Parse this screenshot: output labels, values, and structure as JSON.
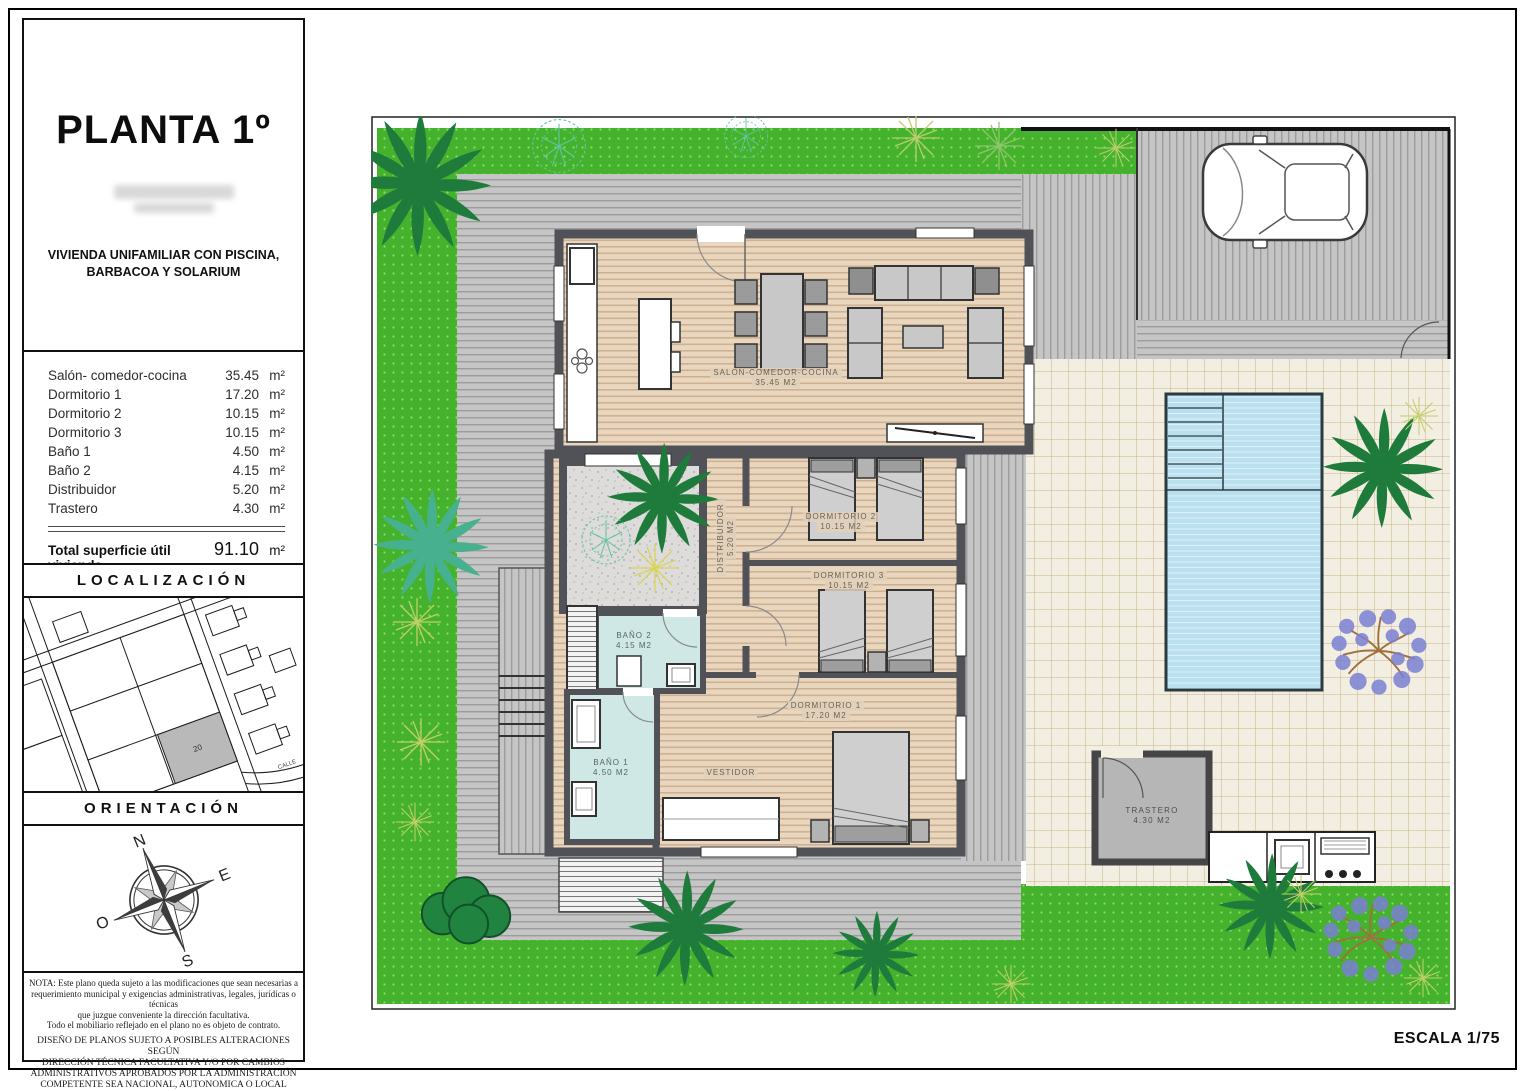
{
  "page": {
    "scale_label": "ESCALA 1/75"
  },
  "sidebar": {
    "title": "PLANTA 1º",
    "subtitle": [
      "VIVIENDA UNIFAMILIAR CON PISCINA,",
      "BARBACOA Y SOLARIUM"
    ],
    "areas": [
      {
        "label": "Salón- comedor-cocina",
        "value": "35.45",
        "unit": "m²"
      },
      {
        "label": "Dormitorio 1",
        "value": "17.20",
        "unit": "m²"
      },
      {
        "label": "Dormitorio 2",
        "value": "10.15",
        "unit": "m²"
      },
      {
        "label": "Dormitorio 3",
        "value": "10.15",
        "unit": "m²"
      },
      {
        "label": "Baño 1",
        "value": "4.50",
        "unit": "m²"
      },
      {
        "label": "Baño 2",
        "value": "4.15",
        "unit": "m²"
      },
      {
        "label": "Distribuidor",
        "value": "5.20",
        "unit": "m²"
      },
      {
        "label": "Trastero",
        "value": "4.30",
        "unit": "m²"
      }
    ],
    "total": {
      "label": "Total superficie útil vivienda",
      "value": "91.10",
      "unit": "m²"
    },
    "solarium": {
      "label": "Solarium",
      "value": "98.56",
      "unit": "m²"
    },
    "localizacion": {
      "header": "LOCALIZACIÓN",
      "parcel_number": "20",
      "street_label": "CALLE"
    },
    "orientacion": {
      "header": "ORIENTACIÓN",
      "compass": {
        "n": "N",
        "e": "E",
        "s": "S",
        "o": "O"
      }
    },
    "notes": {
      "nota_lines": [
        "NOTA: Este plano queda sujeto a las modificaciones que sean necesarias a",
        "requerimiento municipal y exigencias administrativas, legales, jurídicas o técnicas",
        "que juzgue conveniente la dirección facultativa.",
        "Todo el mobiliario reflejado en el plano no es objeto de contrato."
      ],
      "diseno_lines": [
        "DISEÑO DE PLANOS SUJETO A POSIBLES ALTERACIONES SEGÚN",
        "DIRECCIÓN TÉCNICA FACULTATIVA Y/O POR CAMBIOS",
        "ADMINISTRATIVOS APROBADOS POR LA ADMINISTRACIÓN",
        "COMPETENTE SEA NACIONAL, AUTONOMICA O LOCAL"
      ]
    }
  },
  "plan": {
    "labels": {
      "salon": {
        "name": "SALON-COMEDOR-COCINA",
        "area": "35.45 M2"
      },
      "dormitorio1": {
        "name": "DORMITORIO 1",
        "area": "17.20 M2"
      },
      "dormitorio2": {
        "name": "DORMITORIO 2",
        "area": "10.15 M2"
      },
      "dormitorio3": {
        "name": "DORMITORIO 3",
        "area": "10.15 M2"
      },
      "bano1": {
        "name": "BAÑO 1",
        "area": "4.50 M2"
      },
      "bano2": {
        "name": "BAÑO 2",
        "area": "4.15 M2"
      },
      "distribuidor": {
        "name": "DISTRIBUIDOR",
        "area": "5.20 M2"
      },
      "vestidor": {
        "name": "VESTIDOR"
      },
      "trastero": {
        "name": "TRASTERO",
        "area": "4.30 M2"
      }
    },
    "colors": {
      "grass": "#45b22d",
      "grass_dot": "#8fdb63",
      "pool": "#badfee",
      "wood": "#e9d6bf",
      "bath": "#cfe8e6",
      "wall": "#515257",
      "deck": "#c5c5c5",
      "tile": "#f2eee1",
      "jacaranda": "#7b80d2",
      "palm": "#1e7b3c"
    }
  }
}
